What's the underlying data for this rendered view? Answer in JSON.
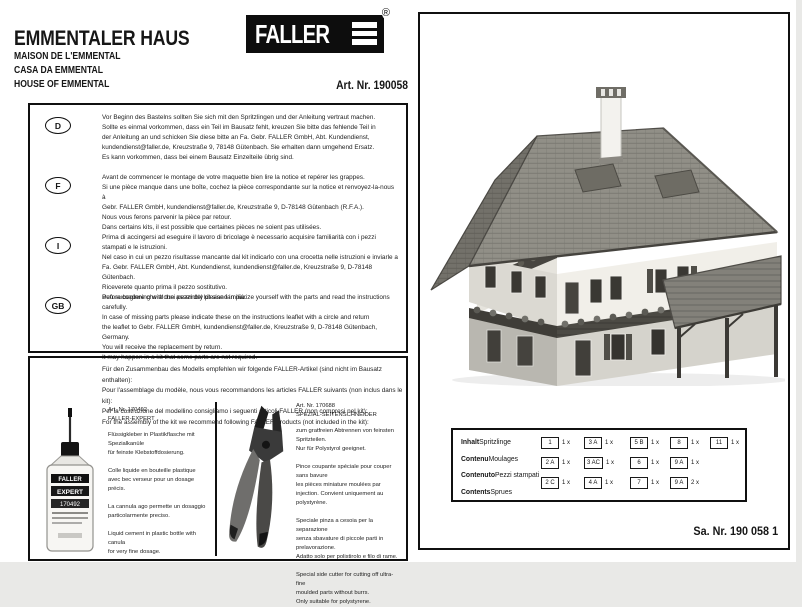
{
  "header": {
    "title": "EMMENTALER HAUS",
    "subtitles": [
      "MAISON DE L'EMMENTAL",
      "CASA DA EMMENTAL",
      "HOUSE OF EMMENTAL"
    ],
    "art_nr": "Art. Nr. 190058",
    "logo_text": "FALLER",
    "logo_registered": "®"
  },
  "notices": [
    {
      "lang": "D",
      "text": "Vor Beginn des Bastelns sollten Sie sich mit den Spritzlingen und der Anleitung vertraut machen.\nSollte es einmal vorkommen, dass ein Teil im Bausatz fehlt, kreuzen Sie bitte das fehlende Teil in\nder Anleitung an und schicken Sie diese bitte an Fa. Gebr. FALLER GmbH, Abt. Kundendienst,\nkundendienst@faller.de, Kreuzstraße 9, 78148 Gütenbach. Sie erhalten dann umgehend Ersatz.\nEs kann vorkommen, dass bei einem Bausatz Einzelteile übrig sind."
    },
    {
      "lang": "F",
      "text": "Avant de commencer le montage de votre maquette bien lire la notice et repérer les grappes.\nSi une pièce manque dans une boîte, cochez la pièce correspondante sur la notice et renvoyez-la-nous à\nGebr. FALLER GmbH, kundendienst@faller.de, Kreuzstraße 9, D-78148 Gütenbach (R.F.A.).\nNous vous ferons parvenir la pièce par retour.\nDans certains kits, il est possible que certaines pièces ne soient pas utilisées."
    },
    {
      "lang": "I",
      "text": "Prima di accingersi ad eseguire il lavoro di bricolage è necessario acquisire familiarità con i pezzi stampati e le istruzioni.\nNel caso in cui un pezzo risultasse mancante dal kit indicarlo con una crocetta nelle istruzioni e inviarle a\nFa. Gebr. FALLER GmbH, Abt. Kundendienst, kundendienst@faller.de, Kreuzstraße 9, D-78148 Gütenbach.\nRiceverete quanto prima il pezzo sostitutivo.\nPuò succedere che alcuni pezzi del kit siano in più."
    },
    {
      "lang": "GB",
      "text": "Before beginning with the assembly please familiarize yourself with the parts and read the instructions carefully.\nIn case of missing parts please indicate these on the instructions leaflet with a circle and return\nthe leaflet to Gebr. FALLER GmbH, kundendienst@faller.de, Kreuzstraße 9, D-78148 Gütenbach, Germany.\nYou will receive the replacement by return.\nIt may happen in a kit that some parts are not required."
    }
  ],
  "recommendation": {
    "intro": "Für den Zusammenbau des Modells empfehlen wir folgende FALLER-Artikel (sind nicht im Bausatz enthalten):\nPour l'assemblage du modèle, nous vous recommandons les articles FALLER suivants (non inclus dans le kit):\nPer la costruzione del modellino consigliamo i seguenti articoli FALLER (non compresi nel kit):\nFor the assembly of the kit we recommend following FALLER products (not included in the kit):",
    "products": [
      {
        "art": "Art. Nr. 170492",
        "name": "FALLER-EXPERT",
        "text": "Flüssigkleber in Plastikflasche mit Spezialkanüle\nfür feinste Klebstoffdosierung.\n\nColle liquide en bouteille plastique\navec bec verseur pour un dosage précis.\n\nLa cannula ago permette un dosaggio\nparticolarmente preciso.\n\nLiquid cement in plastic bottle with canula\nfor very fine dosage.",
        "bottle_label": [
          "FALLER",
          "EXPERT",
          "170492"
        ]
      },
      {
        "art": "Art. Nr. 170688",
        "name": "SPEZIAL-SEITENSCHNEIDER",
        "text": "zum gratfreien Abtrennen von feinsten\nSpritzteilen.\nNur für Polystyrol geeignet.\n\nPince coupante spéciale pour couper sans bavure\nles pièces miniature moulées par\ninjection. Convient uniquement au polystyrène.\n\nSpeciale pinza a cesoia per la separazione\nsenza sbavature di piccole parti in prelavorazione.\nAdatto solo per polistirolo e filo di rame.\n\nSpecial side cutter for cutting off ultra-fine\nmoulded parts without burrs.\nOnly suitable for polystyrene."
      }
    ]
  },
  "contents_table": {
    "labels": [
      {
        "bold": "Inhalt",
        "normal": "Spritzlinge"
      },
      {
        "bold": "Contenu",
        "normal": "Moulages"
      },
      {
        "bold": "Contenuto",
        "normal": "Pezzi stampati"
      },
      {
        "bold": "Contents",
        "normal": "Sprues"
      }
    ],
    "rows": [
      [
        {
          "code": "1",
          "qty": "1 x"
        },
        {
          "code": "3 A",
          "qty": "1 x"
        },
        {
          "code": "5 B",
          "qty": "1 x"
        },
        {
          "code": "8",
          "qty": "1 x"
        },
        {
          "code": "11",
          "qty": "1 x"
        }
      ],
      [
        {
          "code": "2 A",
          "qty": "1 x"
        },
        {
          "code": "3 AC",
          "qty": "1 x"
        },
        {
          "code": "6",
          "qty": "1 x"
        },
        {
          "code": "9 A",
          "qty": "1 x"
        }
      ],
      [
        {
          "code": "2 C",
          "qty": "1 x"
        },
        {
          "code": "4 A",
          "qty": "1 x"
        },
        {
          "code": "7",
          "qty": "1 x"
        },
        {
          "code": "9 A",
          "qty": "2 x"
        }
      ]
    ]
  },
  "footer": {
    "sa_nr": "Sa. Nr. 190 058 1"
  }
}
